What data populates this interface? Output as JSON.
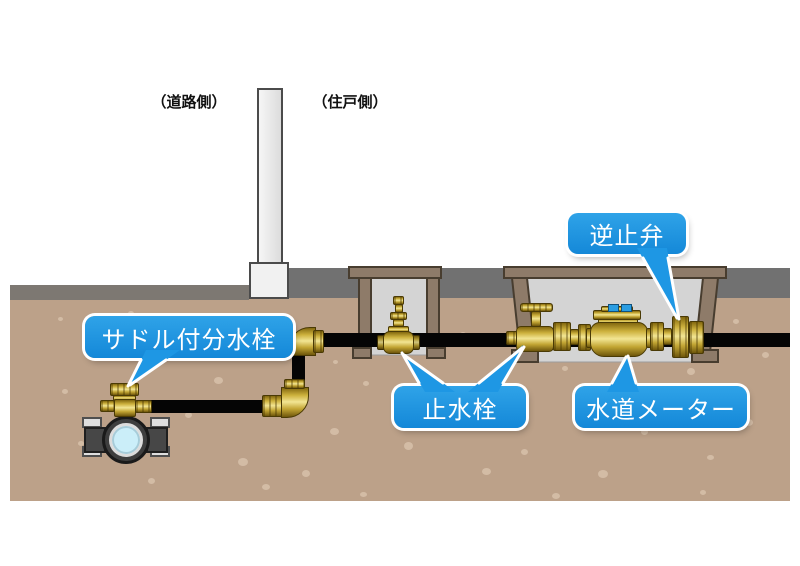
{
  "diagram": {
    "title_labels": {
      "road_side": "（道路側）",
      "house_side": "（住戸側）"
    },
    "callouts": {
      "saddle_tap": "サドル付分水栓",
      "stop_valve": "止水栓",
      "water_meter": "水道メーター",
      "check_valve": "逆止弁"
    },
    "colors": {
      "callout_blue": "#1e97e4",
      "ground_brown": "#bca189",
      "surface_gray": "#717171",
      "road_gray": "#7d7872",
      "brass": "#cdb13d",
      "pipe_black": "#050505",
      "water_blue": "#cbeef9",
      "box_brown": "#8e7b69",
      "box_interior": "#d4d4d4"
    }
  },
  "spots": [
    [
      95,
      338,
      8,
      7
    ],
    [
      62,
      389,
      6,
      5
    ],
    [
      78,
      441,
      6,
      5
    ],
    [
      148,
      478,
      7,
      6
    ],
    [
      185,
      412,
      7,
      6
    ],
    [
      214,
      377,
      9,
      7
    ],
    [
      238,
      458,
      10,
      8
    ],
    [
      262,
      484,
      8,
      6
    ],
    [
      302,
      470,
      8,
      7
    ],
    [
      330,
      428,
      9,
      7
    ],
    [
      363,
      381,
      6,
      5
    ],
    [
      404,
      442,
      9,
      8
    ],
    [
      443,
      408,
      6,
      5
    ],
    [
      482,
      468,
      9,
      7
    ],
    [
      521,
      449,
      7,
      6
    ],
    [
      552,
      493,
      8,
      6
    ],
    [
      562,
      366,
      6,
      5
    ],
    [
      598,
      470,
      10,
      8
    ],
    [
      641,
      429,
      7,
      6
    ],
    [
      677,
      399,
      8,
      6
    ],
    [
      707,
      455,
      7,
      5
    ],
    [
      744,
      419,
      9,
      7
    ],
    [
      762,
      352,
      7,
      6
    ],
    [
      733,
      319,
      6,
      5
    ],
    [
      687,
      368,
      8,
      7
    ],
    [
      460,
      332,
      6,
      5
    ],
    [
      333,
      360,
      5,
      4
    ],
    [
      243,
      332,
      6,
      5
    ],
    [
      128,
      311,
      6,
      5
    ],
    [
      58,
      317,
      5,
      4
    ],
    [
      168,
      350,
      6,
      5
    ],
    [
      360,
      492,
      7,
      5
    ],
    [
      700,
      490,
      6,
      5
    ]
  ]
}
